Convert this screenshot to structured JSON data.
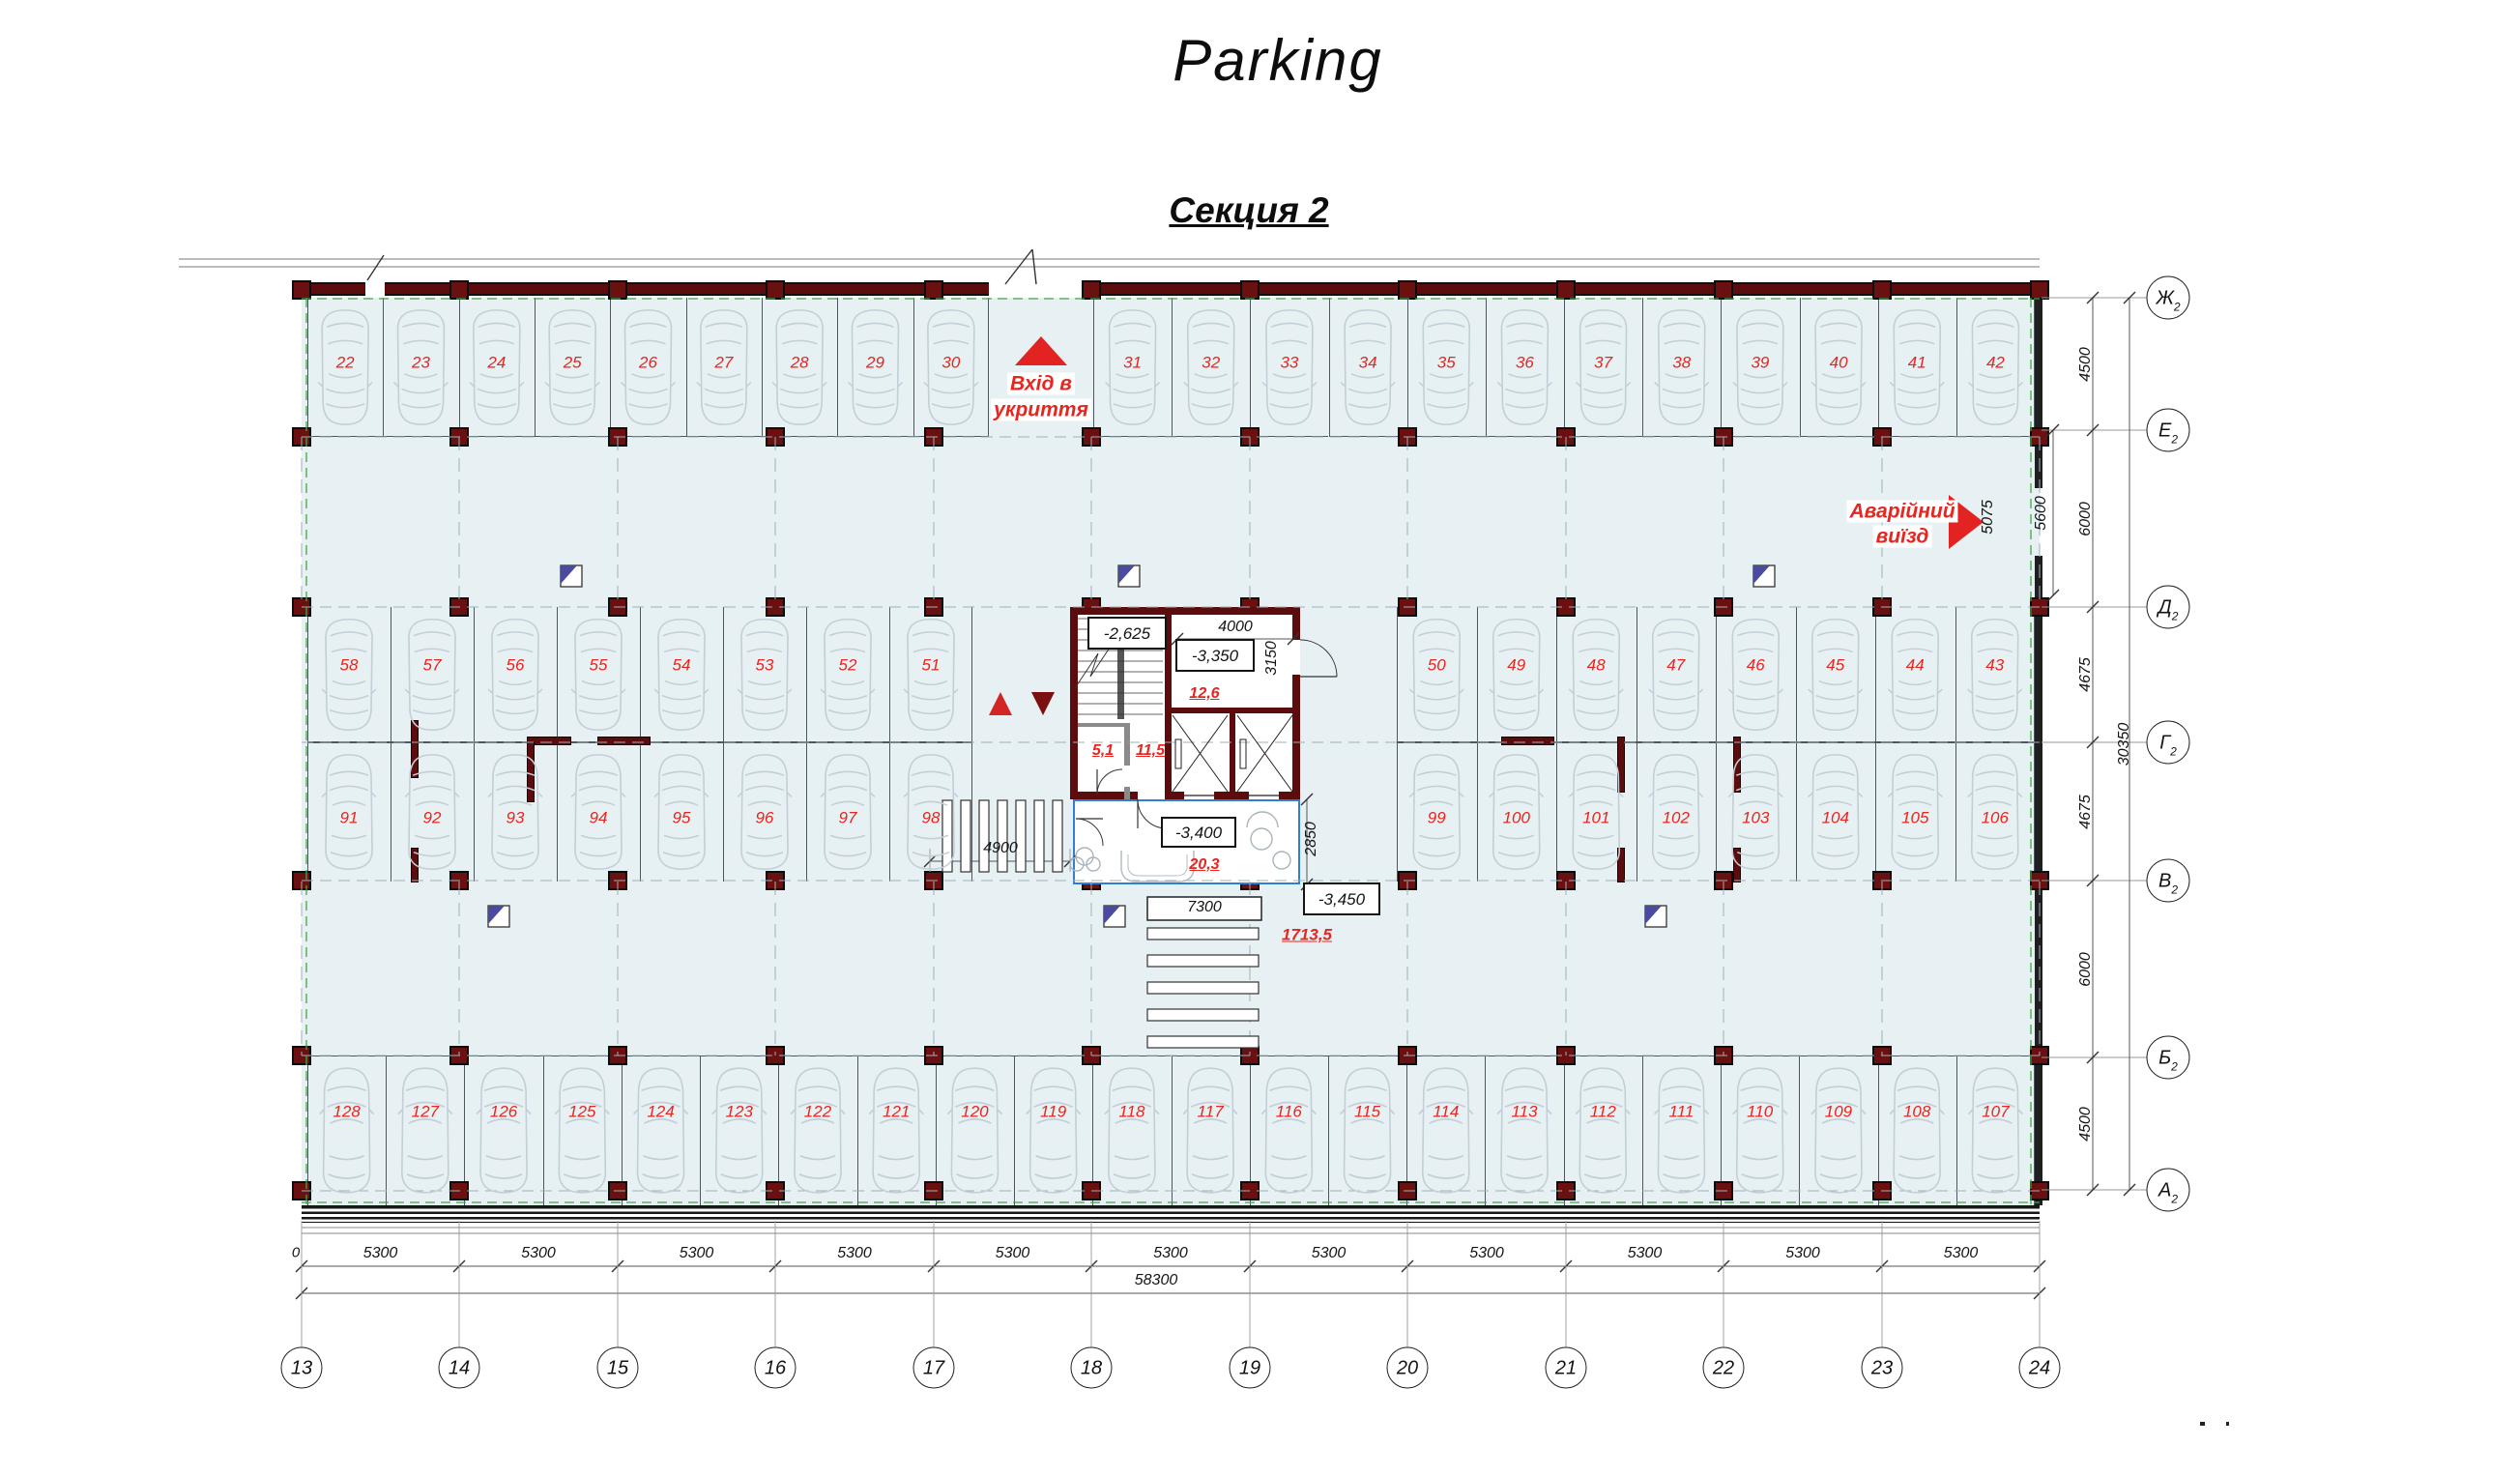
{
  "title": "Parking",
  "subtitle": "Секция 2",
  "entrance": {
    "line1": "Вхід в",
    "line2": "укриття"
  },
  "emergency": {
    "line1": "Аварійний",
    "line2": "виїзд"
  },
  "levels": {
    "stair": "-2,625",
    "room": "-3,350",
    "lobby": "-3,400",
    "aisle": "-3,450"
  },
  "areas": {
    "room": "12,6",
    "wc": "5,1",
    "corridor": "11,5",
    "lobby": "20,3",
    "parking": "1713,5"
  },
  "dims": {
    "bay": "5300",
    "total_width": "58300",
    "zero": "0",
    "total_height": "30350",
    "right_spacings": [
      "4500",
      "6000",
      "4675",
      "4675",
      "6000",
      "4500"
    ],
    "exit_width": "5075",
    "exit_bay": "5600",
    "room_width": "4000",
    "room_depth": "3150",
    "lobby_depth": "2850",
    "ramp": "4900",
    "crosswalk": "7300"
  },
  "axes": {
    "bottom": [
      "13",
      "14",
      "15",
      "16",
      "17",
      "18",
      "19",
      "20",
      "21",
      "22",
      "23",
      "24"
    ],
    "right_letters": [
      "Ж",
      "Е",
      "Д",
      "Г",
      "В",
      "Б",
      "А"
    ],
    "right_sub": "2"
  },
  "spaces": {
    "row1_left": [
      "22",
      "23",
      "24",
      "25",
      "26",
      "27",
      "28",
      "29",
      "30"
    ],
    "row1_right": [
      "31",
      "32",
      "33",
      "34",
      "35",
      "36",
      "37",
      "38",
      "39",
      "40",
      "41",
      "42"
    ],
    "row2_left": [
      "58",
      "57",
      "56",
      "55",
      "54",
      "53",
      "52",
      "51"
    ],
    "row2_right": [
      "50",
      "49",
      "48",
      "47",
      "46",
      "45",
      "44",
      "43"
    ],
    "row3_left": [
      "91",
      "92",
      "93",
      "94",
      "95",
      "96",
      "97",
      "98"
    ],
    "row3_right": [
      "99",
      "100",
      "101",
      "102",
      "103",
      "104",
      "105",
      "106"
    ],
    "row4": [
      "128",
      "127",
      "126",
      "125",
      "124",
      "123",
      "122",
      "121",
      "120",
      "119",
      "118",
      "117",
      "116",
      "115",
      "114",
      "113",
      "112",
      "111",
      "110",
      "109",
      "108",
      "107"
    ]
  },
  "colors": {
    "floor": "#e7f1f4",
    "wall": "#5c0c0c",
    "red": "#e8251f",
    "vestibule_blue": "#2f7fd6",
    "boundary_green": "#3faa3f",
    "car_outline": "#c3ced6"
  }
}
